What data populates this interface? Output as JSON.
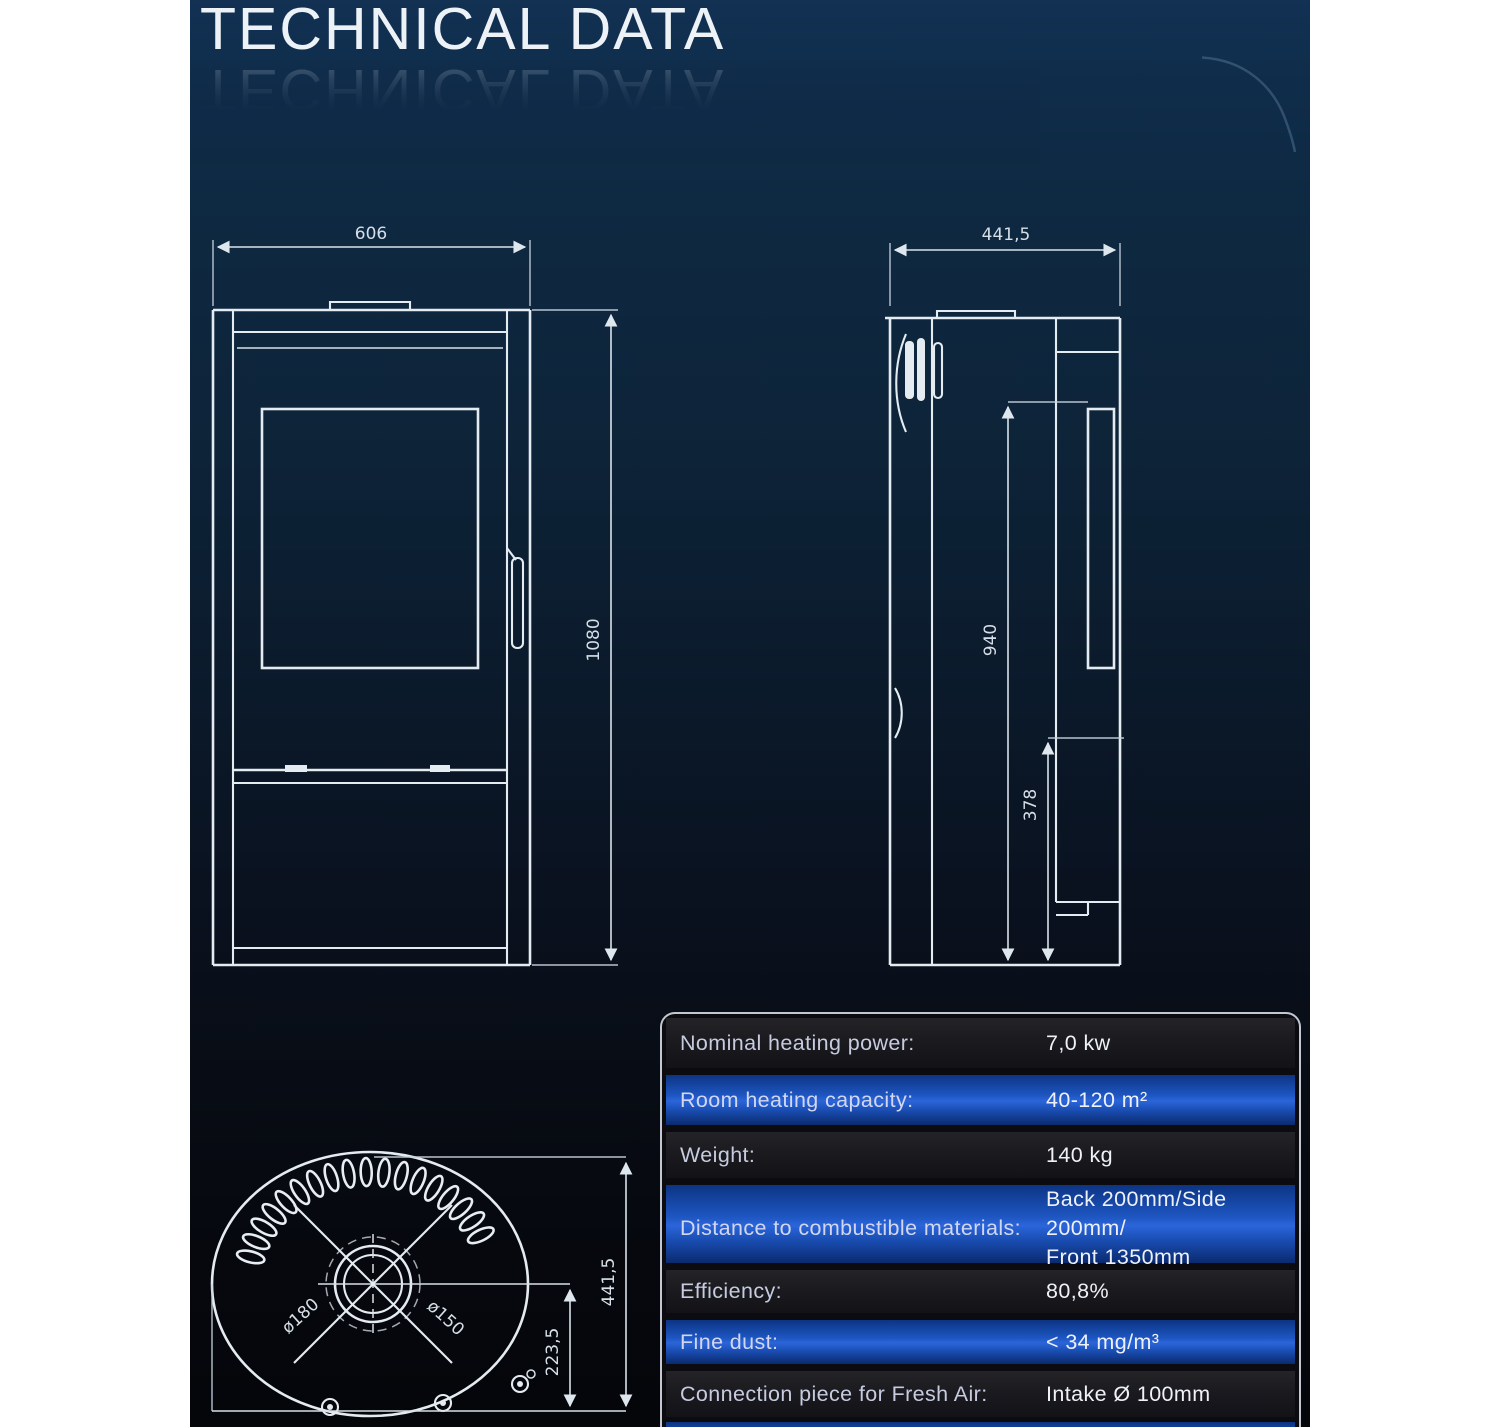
{
  "page": {
    "title": "TECHNICAL DATA"
  },
  "front_view": {
    "width_mm": "606",
    "height_mm": "1080"
  },
  "side_view": {
    "depth_mm": "441,5",
    "flue_height_mm": "940",
    "intake_height_mm": "378"
  },
  "top_view": {
    "flue_diameter_outer": "ø180",
    "flue_diameter_inner": "ø150",
    "flue_center_from_back_mm": "223,5",
    "depth_mm": "441,5"
  },
  "spec_table": {
    "rows": [
      {
        "label": "Nominal heating power:",
        "value": "7,0 kw"
      },
      {
        "label": "Room heating capacity:",
        "value": "40-120 m²"
      },
      {
        "label": "Weight:",
        "value": "140 kg"
      },
      {
        "label": "Distance to combustible materials:",
        "value_line1": "Back 200mm/Side 200mm/",
        "value_line2": "Front 1350mm"
      },
      {
        "label": "Efficiency:",
        "value": "80,8%"
      },
      {
        "label": "Fine dust:",
        "value": "< 34 mg/m³"
      },
      {
        "label": "Connection piece for Fresh Air:",
        "value": "Intake Ø 100mm"
      }
    ]
  },
  "colors": {
    "page_margin": "#ffffff",
    "background_top": "#123153",
    "background_bottom": "#05060a",
    "row_blue": "#1d55c0",
    "row_dark": "#1a1a1f",
    "drawing_line": "#e4ebf1",
    "table_border": "#c3c7d1",
    "title_text": "#edf2f7"
  }
}
